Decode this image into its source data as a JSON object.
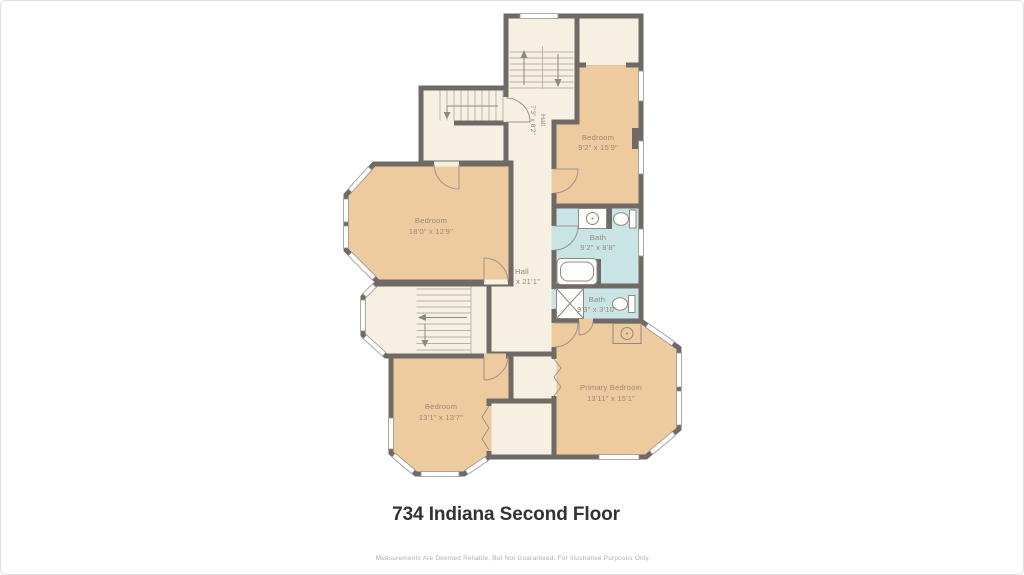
{
  "title": "734 Indiana Second Floor",
  "disclaimer": "Measurements Are Deemed Reliable, But Not Guaranteed. For Illustrative Purposes Only.",
  "rooms": {
    "bedroom_top_right": {
      "name": "Bedroom",
      "dims": "9'2\" x 15'9\""
    },
    "bath_top": {
      "name": "Bath",
      "dims": "9'2\" x 8'8\""
    },
    "bath_bottom": {
      "name": "Bath",
      "dims": "9'3\" x 3'10\""
    },
    "primary_bedroom": {
      "name": "Primary Bedroom",
      "dims": "13'11\" x 15'1\""
    },
    "bedroom_left": {
      "name": "Bedroom",
      "dims": "18'0\" x 12'9\""
    },
    "bedroom_bottom_left": {
      "name": "Bedroom",
      "dims": "13'1\" x 13'7\""
    },
    "hall_upper": {
      "name": "Hall",
      "dims": "7'3\" x 8'2\""
    },
    "hall_main": {
      "name": "Hall",
      "dims": "x 21'1\""
    }
  },
  "colors": {
    "bedroom_fill": "#eeca9f",
    "hall_fill": "#f6f0e3",
    "bath_fill": "#c9e4e4",
    "wall": "#6f6a66"
  }
}
